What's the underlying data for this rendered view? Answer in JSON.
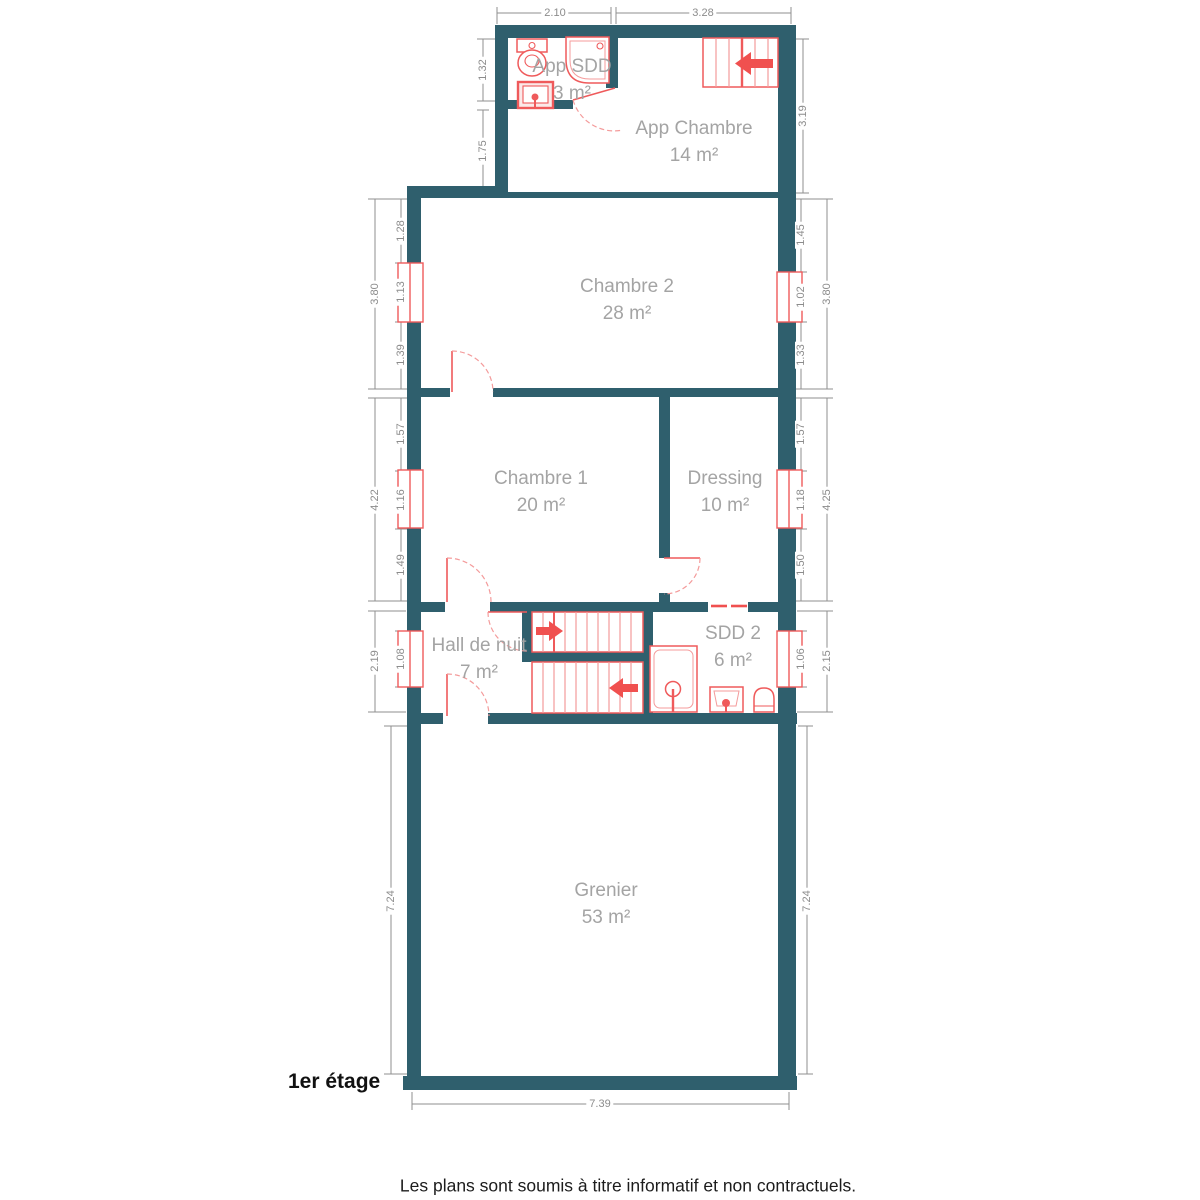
{
  "title": "1er étage",
  "colors": {
    "wall": "#2f5f6d",
    "fixture_red": "#ef5a5b",
    "fixture_light_red": "#f49b9b",
    "arrow_red": "#f0504f",
    "dimension_gray": "#8c8c8c",
    "room_label_gray": "#a4a4a4",
    "background": "#ffffff"
  },
  "rooms": {
    "app_sdd": {
      "name": "App SDD",
      "area": "3 m²"
    },
    "app_chambre": {
      "name": "App Chambre",
      "area": "14 m²"
    },
    "chambre2": {
      "name": "Chambre 2",
      "area": "28 m²"
    },
    "chambre1": {
      "name": "Chambre 1",
      "area": "20 m²"
    },
    "dressing": {
      "name": "Dressing",
      "area": "10 m²"
    },
    "hall": {
      "name": "Hall de nuit",
      "area": "7 m²"
    },
    "sdd2": {
      "name": "SDD 2",
      "area": "6 m²"
    },
    "grenier": {
      "name": "Grenier",
      "area": "53 m²"
    }
  },
  "dimensions": {
    "top_app_sdd": "2.10",
    "top_app_chambre": "3.28",
    "app_left_upper": "1.32",
    "app_left_lower": "1.75",
    "app_right": "3.19",
    "chambre2_left": [
      "1.28",
      "1.13",
      "1.39"
    ],
    "chambre2_left_total": "3.80",
    "chambre2_right": [
      "1.45",
      "1.02",
      "1.33"
    ],
    "chambre2_right_total": "3.80",
    "chambre1_left": [
      "1.57",
      "1.16",
      "1.49"
    ],
    "chambre1_left_total": "4.22",
    "chambre1_right": [
      "1.57",
      "1.18",
      "1.50"
    ],
    "chambre1_right_total": "4.25",
    "hall_left": "1.08",
    "hall_left_total": "2.19",
    "sdd2_right": "1.06",
    "sdd2_right_total": "2.15",
    "grenier_left": "7.24",
    "grenier_right": "7.24",
    "bottom": "7.39"
  },
  "footer": {
    "floor_label": "1er étage",
    "disclaimer": "Les plans sont soumis à titre informatif et non contractuels."
  }
}
